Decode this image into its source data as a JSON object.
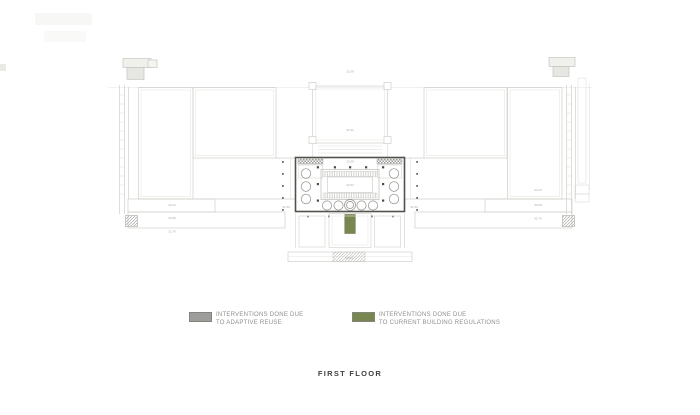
{
  "title": {
    "text": "FIRST FLOOR"
  },
  "legend": {
    "items": [
      {
        "swatch_color": "#9d9d9b",
        "line1": "INTERVENTIONS DONE DUE",
        "line2": "TO ADAPTIVE REUSE"
      },
      {
        "swatch_color": "#78874f",
        "line1": "INTERVENTIONS DONE DUE",
        "line2": "TO CURRENT BUILDING REGULATIONS"
      }
    ]
  },
  "plan": {
    "colors": {
      "outline_light": "#cfcfca",
      "outline_faint": "#e4e4e0",
      "hall_outline": "#52524c",
      "column_dot": "#4c4c47",
      "circle_stroke": "#8e8e89",
      "intervention_gray": "#9a9a96",
      "intervention_green": "#78874f"
    },
    "dimension_labels": [
      {
        "x": 350,
        "y": 72.5,
        "text": "32.08"
      },
      {
        "x": 350,
        "y": 131,
        "text": "31.92"
      },
      {
        "x": 350,
        "y": 162.5,
        "text": "32.08"
      },
      {
        "x": 350,
        "y": 186,
        "text": "30.62"
      },
      {
        "x": 172,
        "y": 206,
        "text": "33.44"
      },
      {
        "x": 172,
        "y": 219,
        "text": "33.08"
      },
      {
        "x": 172,
        "y": 232.5,
        "text": "32.76"
      },
      {
        "x": 538,
        "y": 191,
        "text": "33.44"
      },
      {
        "x": 538,
        "y": 206,
        "text": "33.08"
      },
      {
        "x": 538,
        "y": 219.5,
        "text": "32.76"
      },
      {
        "x": 349,
        "y": 258.8,
        "text": "29.84"
      },
      {
        "x": 286,
        "y": 208,
        "text": "31.50"
      },
      {
        "x": 414,
        "y": 208,
        "text": "31.50"
      }
    ]
  }
}
